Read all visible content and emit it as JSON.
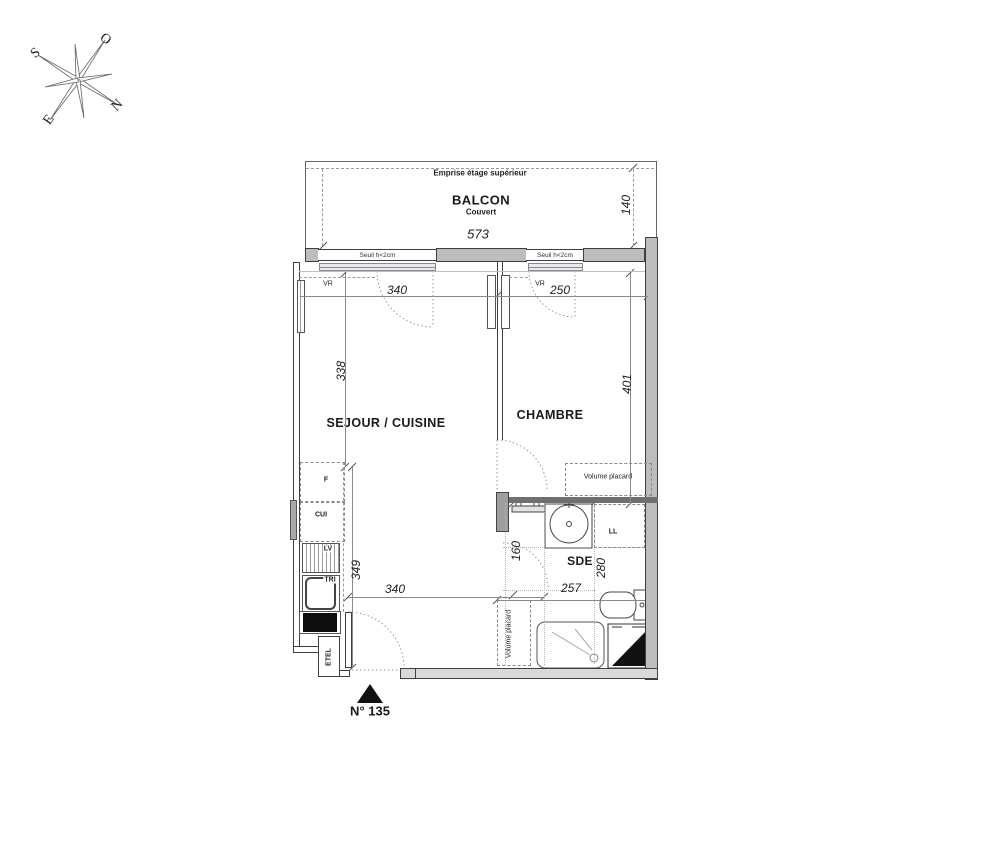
{
  "compass": {
    "north_label": "N",
    "south_label": "S",
    "east_label": "E",
    "west_label": "O"
  },
  "balcony": {
    "upper_floor_outline": "Emprise étage supérieur",
    "name": "BALCON",
    "covered": "Couvert",
    "width_cm": "573",
    "depth_cm": "140"
  },
  "openings": {
    "threshold_living": "Seuil h<2cm",
    "threshold_bedroom": "Seuil h<2cm",
    "shutter_living": "VR",
    "shutter_bedroom": "VR"
  },
  "rooms": {
    "living_kitchen": "SEJOUR / CUISINE",
    "bedroom": "CHAMBRE",
    "shower_room": "SDE"
  },
  "dims": {
    "living_width_top": "340",
    "bedroom_width_top": "250",
    "living_depth": "338",
    "bedroom_depth": "401",
    "kitchen_run": "349",
    "living_width_bottom": "340",
    "shower_room_width": "257",
    "shower_room_depth": "280",
    "hall_depth": "160"
  },
  "equipment": {
    "fridge": "F",
    "cooktop": "CUI",
    "dishwasher": "LV",
    "waste_sorting": "TRI",
    "electrical_closet": "ETEL",
    "washing_machine": "LL",
    "bedroom_closet": "Volume placard",
    "hall_closet": "Volume placard"
  },
  "unit": {
    "number": "N° 135"
  },
  "colors": {
    "wall_fill": "#bdbdbd",
    "line": "#3f3f3f",
    "guide": "#9a9a9a"
  }
}
